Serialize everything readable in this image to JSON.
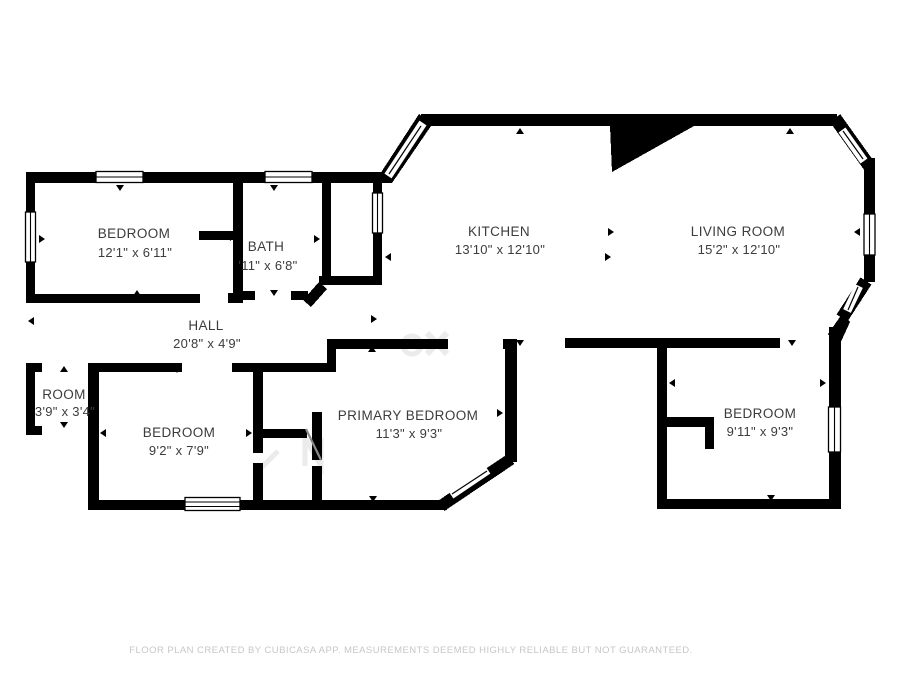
{
  "plan": {
    "rooms": [
      {
        "id": "bedroom-top-left",
        "name": "BEDROOM",
        "dims": "12'1\" x 6'11\""
      },
      {
        "id": "bath",
        "name": "BATH",
        "dims": "'11\" x 6'8\""
      },
      {
        "id": "kitchen",
        "name": "KITCHEN",
        "dims": "13'10\" x 12'10\""
      },
      {
        "id": "living-room",
        "name": "LIVING ROOM",
        "dims": "15'2\" x 12'10\""
      },
      {
        "id": "hall",
        "name": "HALL",
        "dims": "20'8\" x 4'9\""
      },
      {
        "id": "room",
        "name": "ROOM",
        "dims": "3'9\" x 3'4\""
      },
      {
        "id": "bedroom-bottom-left",
        "name": "BEDROOM",
        "dims": "9'2\" x 7'9\""
      },
      {
        "id": "primary-bedroom",
        "name": "PRIMARY BEDROOM",
        "dims": "11'3\" x 9'3\""
      },
      {
        "id": "bedroom-bottom-right",
        "name": "BEDROOM",
        "dims": "9'11\" x 9'3\""
      }
    ],
    "footer": "FLOOR PLAN CREATED BY CUBICASA APP. MEASUREMENTS DEEMED HIGHLY RELIABLE BUT NOT GUARANTEED.",
    "colors": {
      "wall": "#000000",
      "background": "#ffffff",
      "label": "#3c3c3c",
      "footer": "#c7c7c7"
    }
  }
}
